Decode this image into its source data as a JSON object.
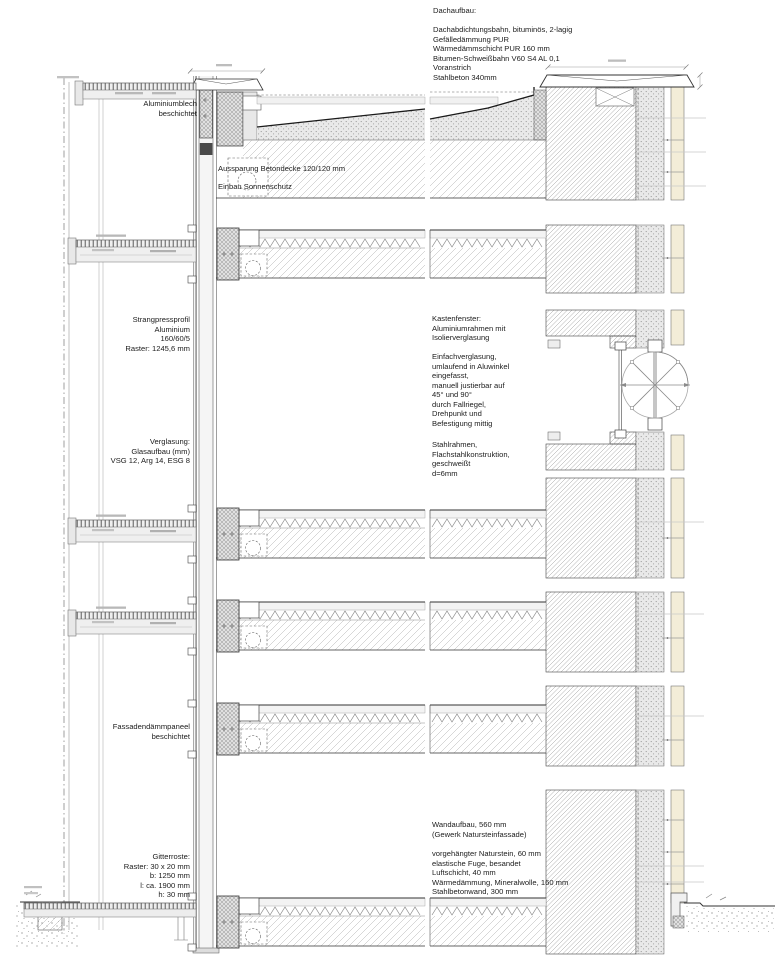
{
  "drawing": {
    "kind": "facade-section-details",
    "annotations": {
      "dachaufbau": "Dachaufbau:\n\nDachabdichtungsbahn, bituminös, 2-lagig\nGefälledämmung PUR\nWärmedämmschicht PUR 160 mm\nBitumen-Schweißbahn V60 S4 AL 0,1\nVoranstrich\nStahlbeton 340mm",
      "aluminiumblech": "Aluminiumblech\nbeschichtet",
      "aussparung": "Aussparung Betondecke 120/120 mm",
      "einbau": "Einbau Sonnenschutz",
      "strangpressprofil": "Strangpressprofil\nAluminium\n160/60/5\nRaster: 1245,6 mm",
      "verglasung": "Verglasung:\nGlasaufbau (mm)\nVSG 12, Arg 14, ESG 8",
      "kastenfenster": "Kastenfenster:\nAluminiumrahmen mit\nIsolierverglasung",
      "einfachverglasung": "Einfachverglasung,\numlaufend in Aluwinkel\neingefasst,\nmanuell justierbar auf\n45° und 90°\ndurch Fallriegel,\nDrehpunkt und\nBefestigung mittig",
      "stahlrahmen": "Stahlrahmen,\nFlachstahlkonstruktion,\ngeschweißt\nd=6mm",
      "fassadendaemmpaneel": "Fassadendämmpaneel\nbeschichtet",
      "gitterroste": "Gitterroste:\nRaster: 30 x 20 mm\nb: 1250 mm\nl: ca. 1900 mm\nh: 30 mm",
      "wandaufbau": "Wandaufbau, 560 mm\n(Gewerk Natursteinfassade)",
      "wandaufbau_layers": "vorgehängter Naturstein, 60 mm\nelastische Fuge, besandet\nLuftschicht, 40 mm\nWärmedämmung, Mineralwolle, 160 mm\nStahlbetonwand, 300 mm"
    },
    "colors": {
      "background": "#ffffff",
      "line_dark": "#2b2b2b",
      "line_medium": "#666666",
      "hatch_light": "#adadad",
      "stone_fill": "#f3edd8",
      "insulation_fill": "#e9e9e9",
      "panel_fill": "#efefef"
    }
  }
}
